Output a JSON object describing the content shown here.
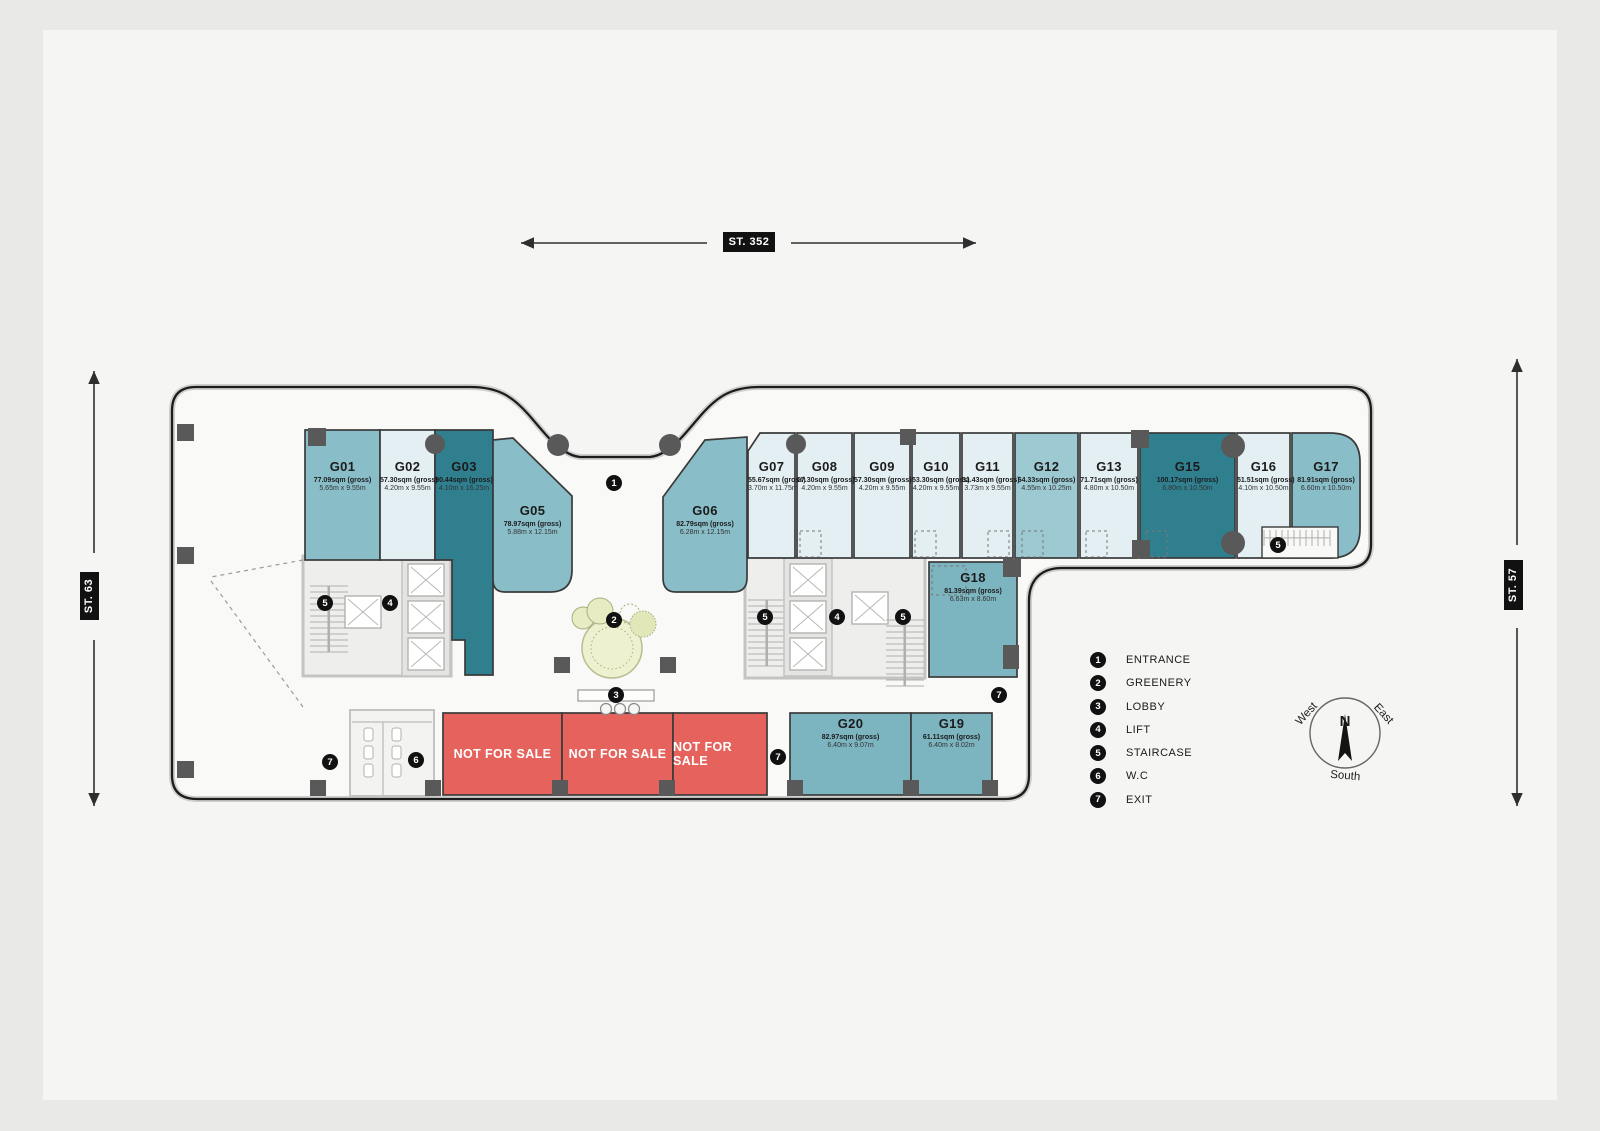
{
  "streets": {
    "top": "ST. 352",
    "left": "ST. 63",
    "right": "ST. 57"
  },
  "units": [
    {
      "id": "G01",
      "area": "77.09sqm (gross)",
      "dims": "5.65m x 9.55m",
      "color": "mid"
    },
    {
      "id": "G02",
      "area": "57.30sqm (gross)",
      "dims": "4.20m x 9.55m",
      "color": "light"
    },
    {
      "id": "G03",
      "area": "90.44sqm (gross)",
      "dims": "4.10m x 16.25m",
      "color": "dark"
    },
    {
      "id": "G05",
      "area": "78.97sqm (gross)",
      "dims": "5.88m x 12.15m",
      "color": "mid"
    },
    {
      "id": "G06",
      "area": "82.79sqm (gross)",
      "dims": "6.28m x 12.15m",
      "color": "mid"
    },
    {
      "id": "G07",
      "area": "55.67sqm (gross)",
      "dims": "3.70m x 11.75m",
      "color": "light"
    },
    {
      "id": "G08",
      "area": "57.30sqm (gross)",
      "dims": "4.20m x 9.55m",
      "color": "light"
    },
    {
      "id": "G09",
      "area": "57.30sqm (gross)",
      "dims": "4.20m x 9.55m",
      "color": "light"
    },
    {
      "id": "G10",
      "area": "53.30sqm (gross)",
      "dims": "4.20m x 9.55m",
      "color": "light"
    },
    {
      "id": "G11",
      "area": "51.43sqm (gross)",
      "dims": "3.73m x 9.55m",
      "color": "light"
    },
    {
      "id": "G12",
      "area": "64.33sqm (gross)",
      "dims": "4.55m x 10.25m",
      "color": "mid2"
    },
    {
      "id": "G13",
      "area": "71.71sqm (gross)",
      "dims": "4.80m x 10.50m",
      "color": "light"
    },
    {
      "id": "G15",
      "area": "100.17sqm (gross)",
      "dims": "6.80m x 10.50m",
      "color": "dark"
    },
    {
      "id": "G16",
      "area": "51.51sqm (gross)",
      "dims": "4.10m x 10.50m",
      "color": "light"
    },
    {
      "id": "G17",
      "area": "81.91sqm (gross)",
      "dims": "6.60m x 10.50m",
      "color": "mid"
    },
    {
      "id": "G18",
      "area": "81.39sqm (gross)",
      "dims": "6.63m x 8.60m",
      "color": "mid3"
    },
    {
      "id": "G19",
      "area": "61.11sqm (gross)",
      "dims": "6.40m x 8.02m",
      "color": "mid3"
    },
    {
      "id": "G20",
      "area": "82.97sqm (gross)",
      "dims": "6.40m x 9.07m",
      "color": "mid3"
    }
  ],
  "not_for_sale_label": "NOT FOR SALE",
  "legend": [
    {
      "num": "1",
      "label": "ENTRANCE"
    },
    {
      "num": "2",
      "label": "GREENERY"
    },
    {
      "num": "3",
      "label": "LOBBY"
    },
    {
      "num": "4",
      "label": "LIFT"
    },
    {
      "num": "5",
      "label": "STAIRCASE"
    },
    {
      "num": "6",
      "label": "W.C"
    },
    {
      "num": "7",
      "label": "EXIT"
    }
  ],
  "markers": [
    "1",
    "2",
    "3",
    "4",
    "4",
    "5",
    "5",
    "5",
    "5",
    "6",
    "7",
    "7",
    "7"
  ],
  "compass": {
    "north": "N",
    "west": "West",
    "east": "East",
    "south": "South"
  },
  "palette": {
    "dark": "#2f7f8f",
    "mid": "#89bdc8",
    "mid2": "#9dc9d2",
    "mid3": "#7cb4bf",
    "light": "#e3eff3",
    "red": "#e6635d"
  }
}
